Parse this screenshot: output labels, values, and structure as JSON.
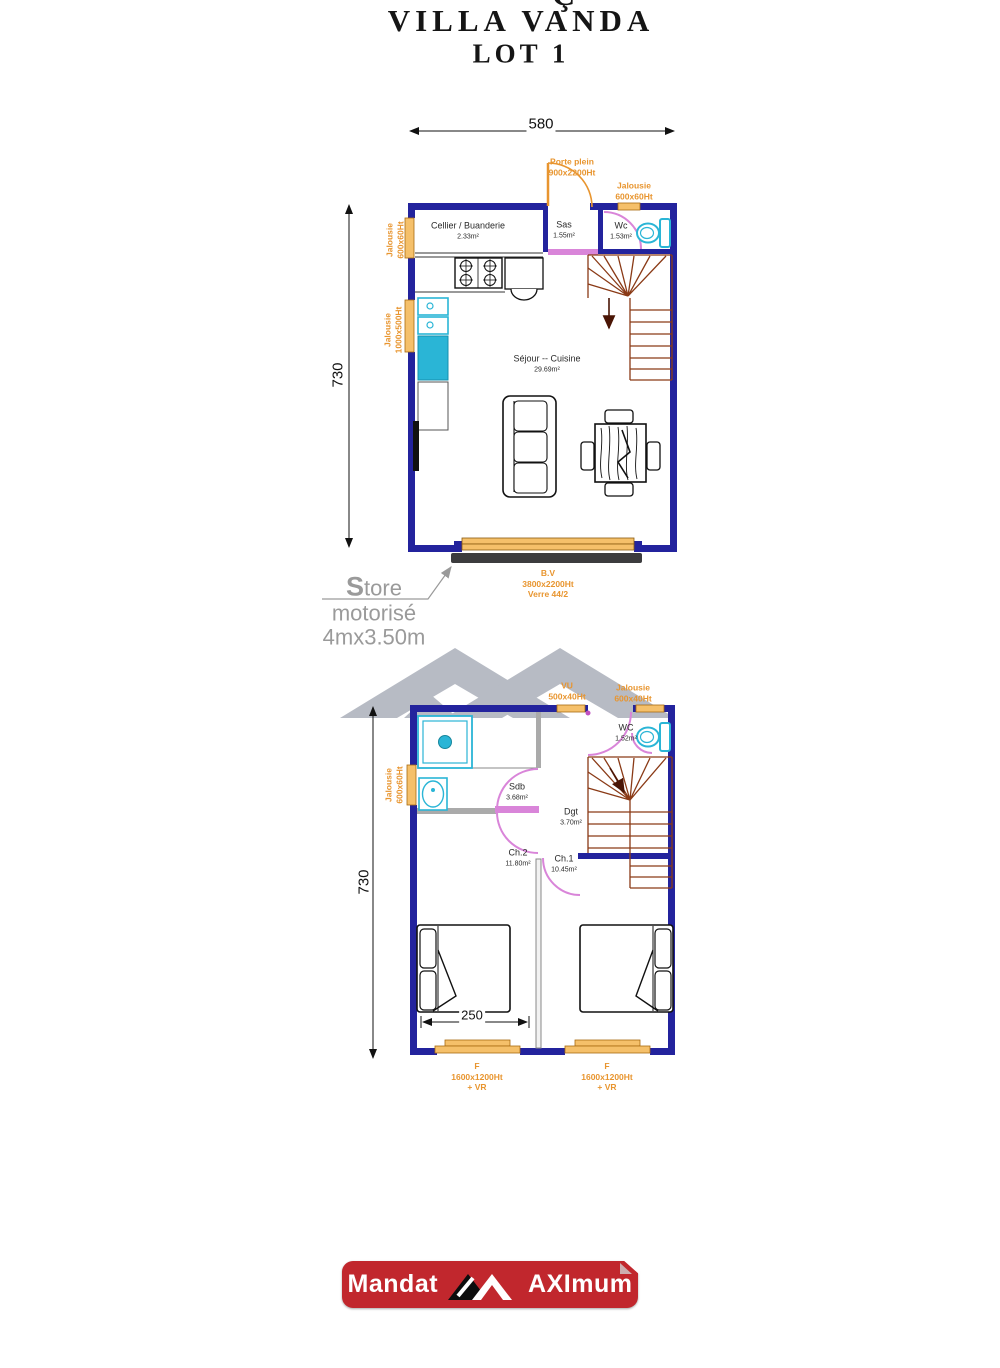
{
  "title": {
    "partial": "Ç",
    "main": "VILLA VANDA",
    "lot": "LOT 1"
  },
  "floor1": {
    "dim_top": "580",
    "dim_left": "730",
    "door_label": "Porte plein\n900x2200Ht",
    "jalousie_topright": "Jalousie\n600x60Ht",
    "jalousie_left_upper": "Jalousie\n600x60Ht",
    "jalousie_left_lower": "Jalousie\n1000x500Ht",
    "rooms": {
      "cellier": {
        "name": "Cellier / Buanderie",
        "area": "2.33m²"
      },
      "sas": {
        "name": "Sas",
        "area": "1.55m²"
      },
      "wc": {
        "name": "Wc",
        "area": "1.53m²"
      },
      "sejour": {
        "name": "Séjour -- Cuisine",
        "area": "29.69m²"
      }
    },
    "bay_label": "B.V\n3800x2200Ht\nVerre 44/2",
    "store_label": "Store\nmotorisé\n4mx3.50m"
  },
  "floor2": {
    "dim_left": "730",
    "dim_bed": "250",
    "vu_label": "VU\n500x40Ht",
    "jalousie_top": "Jalousie\n600x40Ht",
    "jalousie_left": "Jalousie\n600x60Ht",
    "rooms": {
      "sdb": {
        "name": "Sdb",
        "area": "3.68m²"
      },
      "wc": {
        "name": "WC",
        "area": "1.52m²"
      },
      "dgt": {
        "name": "Dgt",
        "area": "3.70m²"
      },
      "ch2": {
        "name": "Ch.2",
        "area": "11.80m²"
      },
      "ch1": {
        "name": "Ch.1",
        "area": "10.45m²"
      }
    },
    "window_left": "F\n1600x1200Ht\n+ VR",
    "window_right": "F\n1600x1200Ht\n+ VR"
  },
  "footer": {
    "mandat": "Mandat",
    "brand": "AXImum"
  },
  "colors": {
    "wall": "#23239d",
    "orange": "#e8952f",
    "stair": "#8a3a16",
    "pink": "#d985d9",
    "cyan": "#2ab5d6",
    "red": "#c1272d"
  }
}
